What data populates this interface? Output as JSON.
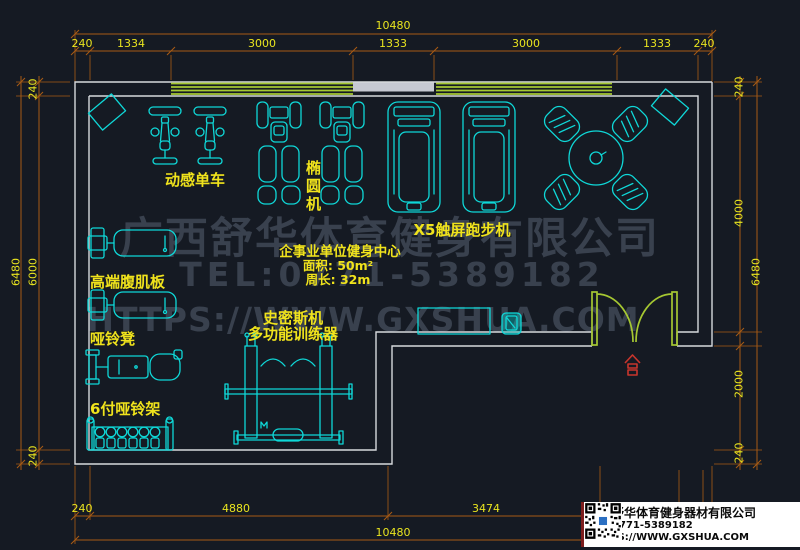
{
  "drawing": {
    "type": "CAD floor plan",
    "room_info": {
      "line1": "企事业单位健身中心",
      "line2": "面积: 50m²",
      "line3": "周长: 32m"
    },
    "equipment_labels": {
      "spin_bike": "动感单车",
      "elliptical": "椭圆机",
      "treadmill": "X5触屏跑步机",
      "ab_board": "高端腹肌板",
      "dumbbell_bench": "哑铃凳",
      "dumbbell_rack": "6付哑铃架",
      "smith_line1": "史密斯机",
      "smith_line2": "多功能训练器"
    }
  },
  "dims": {
    "top": {
      "overall": "10480",
      "segments": [
        "240",
        "1334",
        "3000",
        "1333",
        "3000",
        "1333",
        "240"
      ]
    },
    "bottom": {
      "overall": "10480",
      "segments": [
        "240",
        "4880",
        "3474"
      ]
    },
    "left": {
      "overall": "6480",
      "segments": [
        "240",
        "6000",
        "240"
      ]
    },
    "right": {
      "overall": "6480",
      "segments": [
        "240",
        "4000",
        "2000",
        "240"
      ]
    }
  },
  "watermark": {
    "line1": "广西舒华体育健身有限公司",
    "line2": "TEL:0771-5389182",
    "line3": "HTTPS://WWW.GXSHUA.COM"
  },
  "title_block": {
    "company": "广西舒华体育健身器材有限公司",
    "tel": "TEL:0771-5389182",
    "url": "HTTPS://WWW.GXSHUA.COM"
  },
  "colors": {
    "background": "#151a23",
    "line_cyan": "#0fd8d8",
    "wall_white": "#d6d9dd",
    "window_green": "#a6c832",
    "dim_orange": "#a85b14",
    "text_yellow": "#f0e31c",
    "watermark_gray": "#39414e",
    "marker_red": "#c8352c"
  }
}
